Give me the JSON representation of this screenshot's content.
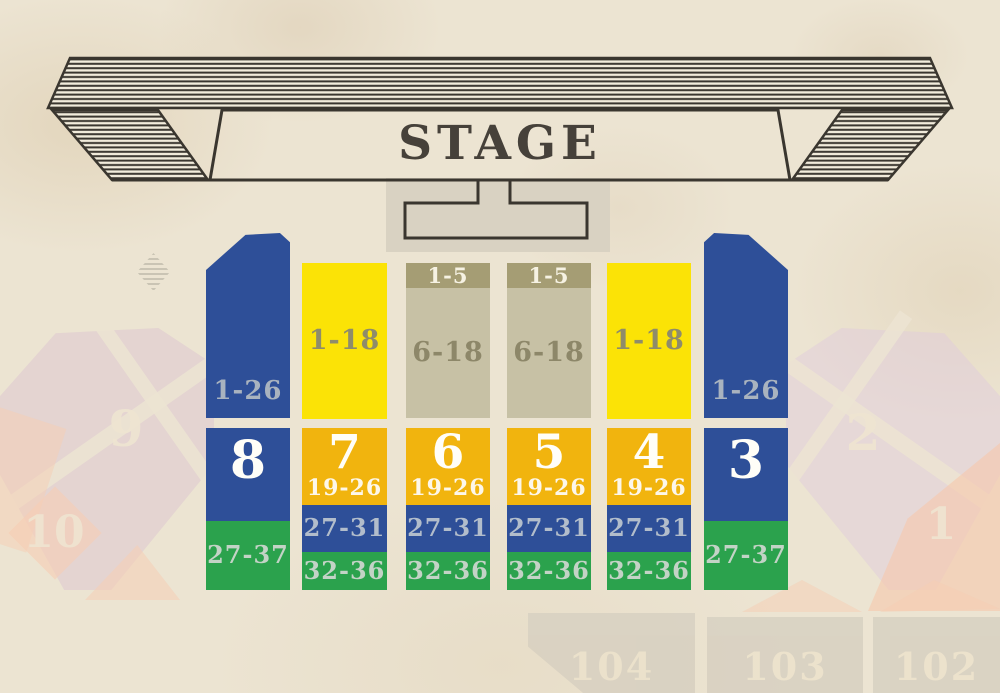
{
  "stage": {
    "label": "STAGE"
  },
  "sections": {
    "outer_left": {
      "number": "8",
      "rows_top": "1-26",
      "rows_bottom": "27-37"
    },
    "outer_right": {
      "number": "3",
      "rows_top": "1-26",
      "rows_bottom": "27-37"
    },
    "inner": [
      {
        "number": "7",
        "rows_top": "1-18",
        "rows_mid": "19-26",
        "rows_blue": "27-31",
        "rows_green": "32-36"
      },
      {
        "number": "6",
        "rows_header": "1-5",
        "rows_top": "6-18",
        "rows_mid": "19-26",
        "rows_blue": "27-31",
        "rows_green": "32-36"
      },
      {
        "number": "5",
        "rows_header": "1-5",
        "rows_top": "6-18",
        "rows_mid": "19-26",
        "rows_blue": "27-31",
        "rows_green": "32-36"
      },
      {
        "number": "4",
        "rows_top": "1-18",
        "rows_mid": "19-26",
        "rows_blue": "27-31",
        "rows_green": "32-36"
      }
    ]
  },
  "background_sections": {
    "left": [
      {
        "label": "9"
      },
      {
        "label": "10"
      }
    ],
    "right": [
      {
        "label": "2"
      },
      {
        "label": "1"
      }
    ],
    "bottom": [
      {
        "label": "104"
      },
      {
        "label": "103"
      },
      {
        "label": "102"
      }
    ]
  },
  "colors": {
    "blue": "#2e4f98",
    "yellow": "#fbe306",
    "amber": "#f1b40e",
    "green": "#2ba24d",
    "khaki": "#c7c1a5",
    "khaki_header": "#a59d74",
    "paper": "#ece4d2",
    "banner_ink": "#3a362f",
    "stage_text": "#46413a",
    "faint_purple": "#dcc4d0",
    "faint_salmon": "#f6cdb4",
    "faint_gray": "#d6cfc0"
  }
}
